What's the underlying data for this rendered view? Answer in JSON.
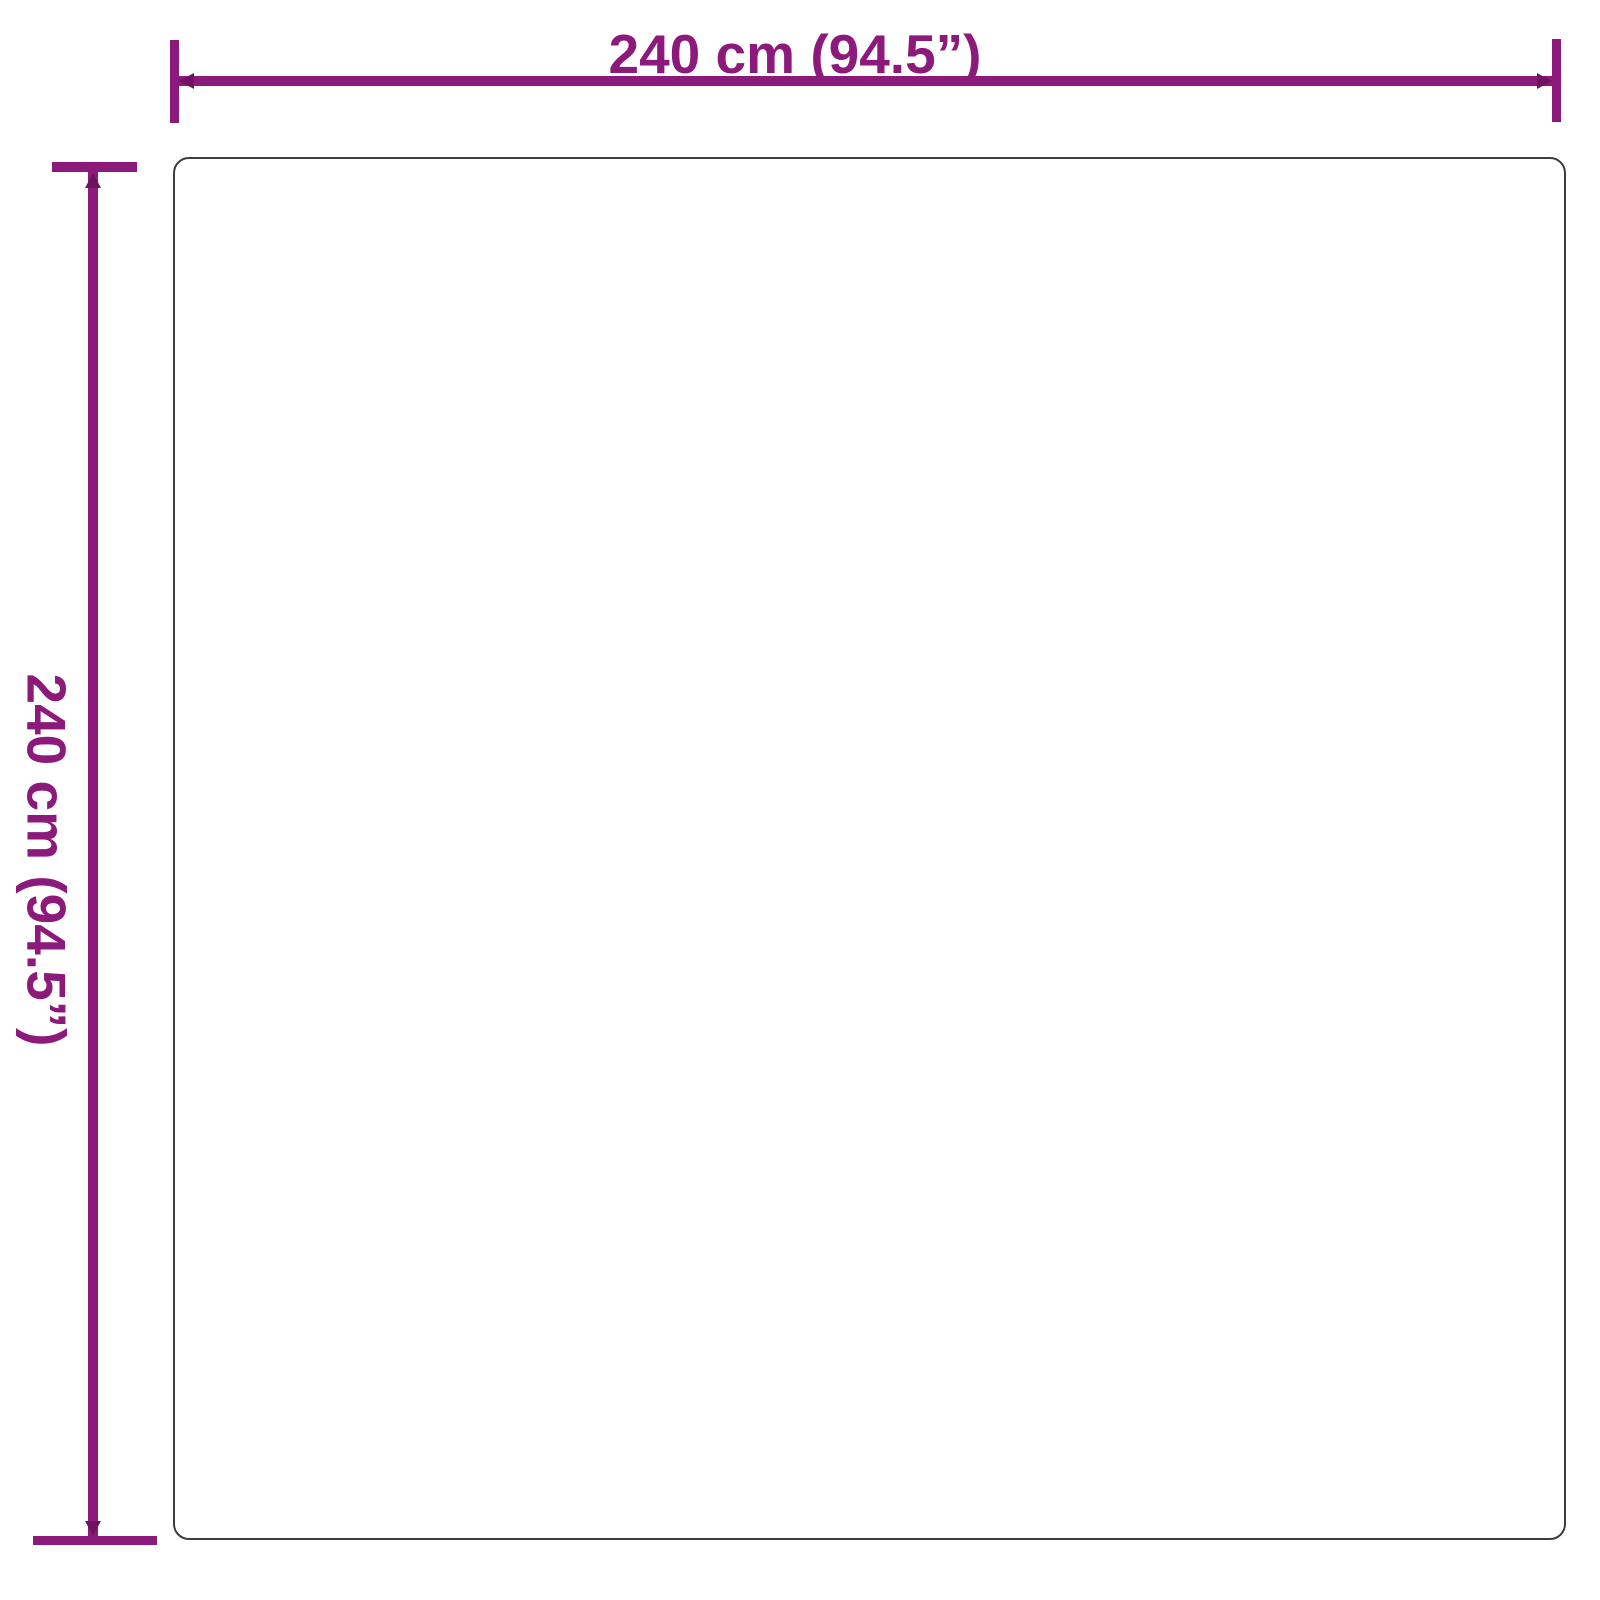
{
  "diagram": {
    "type": "product-dimension-diagram",
    "shape": "square-outline",
    "width_label": "240 cm (94.5”)",
    "height_label": "240 cm (94.5”)"
  },
  "colors": {
    "dimension_accent": "#8C1A7B",
    "dimension_accent_dark": "#70125f",
    "outline": "#3d3d3d",
    "background": "#ffffff"
  }
}
